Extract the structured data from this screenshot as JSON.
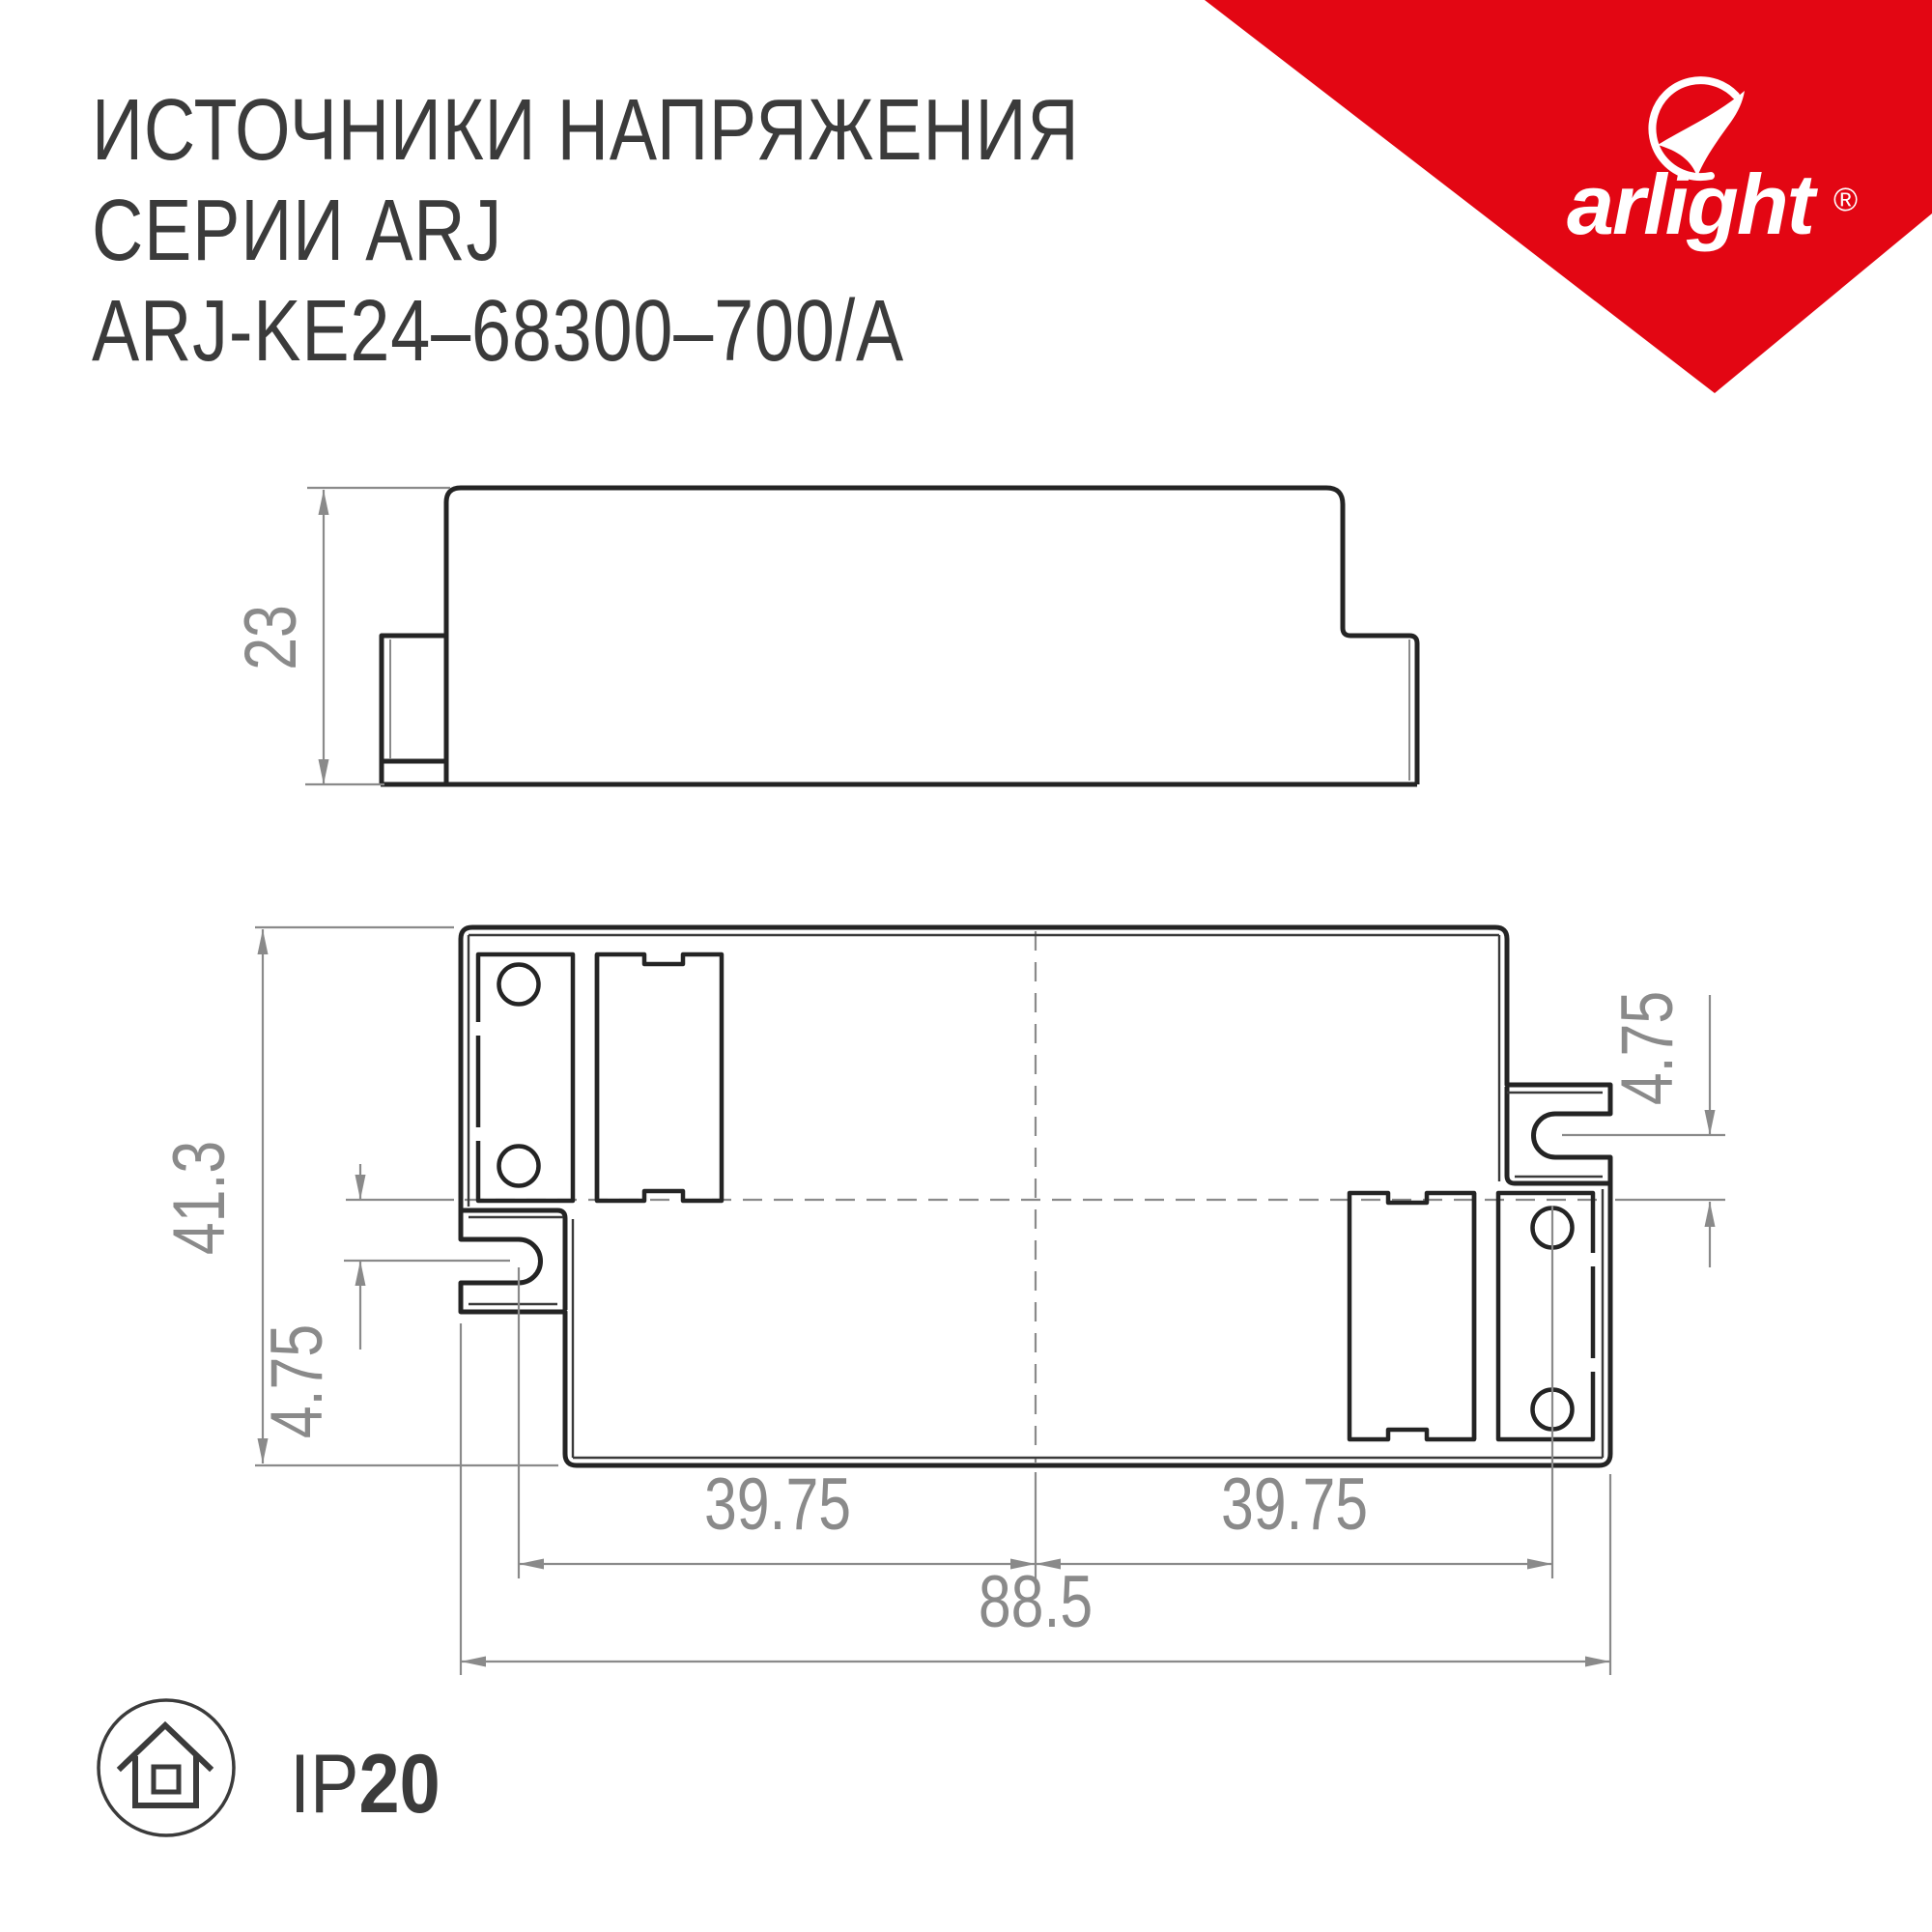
{
  "title": {
    "line1": "ИСТОЧНИКИ НАПРЯЖЕНИЯ",
    "line2": "СЕРИИ ARJ",
    "line3": "ARJ-KE24–68300–700/A"
  },
  "brand": {
    "name": "arlight",
    "registered": "®",
    "color": "#e30613"
  },
  "side_view": {
    "height": "23"
  },
  "top_view": {
    "overall_height": "41.3",
    "overall_width": "88.5",
    "slot_offset_left": "4.75",
    "slot_offset_right": "4.75",
    "mount_spacing_left": "39.75",
    "mount_spacing_right": "39.75"
  },
  "protection": {
    "prefix": "IP",
    "rating": "20"
  },
  "colors": {
    "accent": "#e30613",
    "line": "#242424",
    "dimension": "#8a8a8a",
    "text": "#3b3b3b"
  }
}
